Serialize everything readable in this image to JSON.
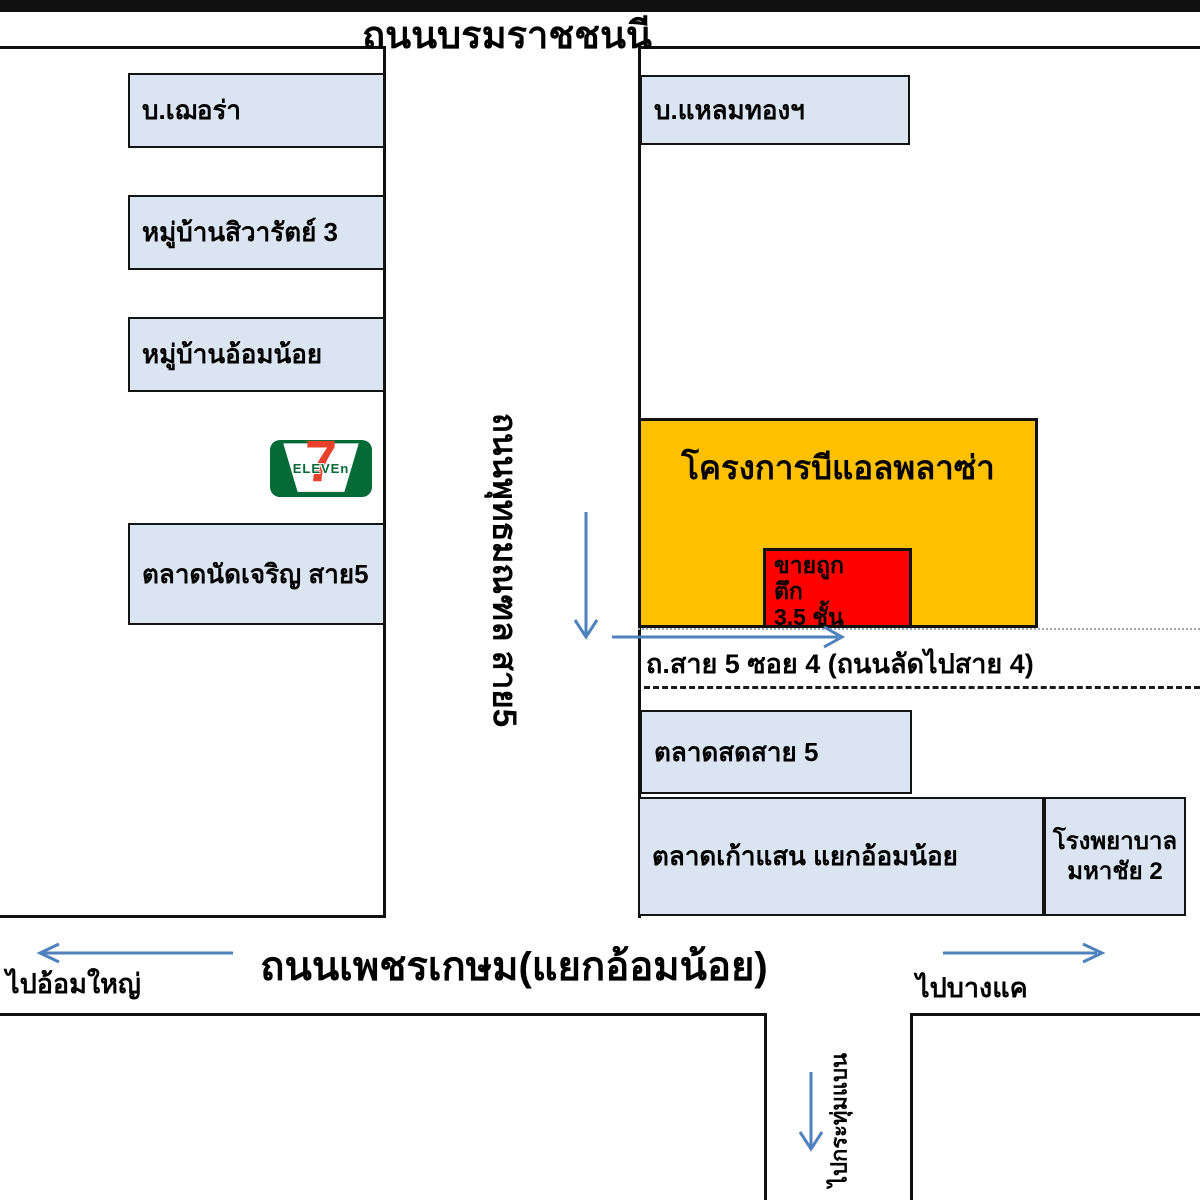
{
  "roads": {
    "top": "ถนนบรมราชชนนี",
    "sai5": "ถนนพุทธมณฑล สาย5",
    "soi": "ถ.สาย 5 ซอย 4 (ถนนลัดไปสาย 4)",
    "phetkasem": "ถนนเพชรเกษม(แยกอ้อมน้อย)",
    "to_om_yai": "ไปอ้อมใหญ่",
    "to_bang_khae": "ไปบางแค",
    "to_krathum_baen": "ไปกระทุ่มแบน"
  },
  "left_area": {
    "chera": "บ.เฌอร่า",
    "siwarat_village": "หมู่บ้านสิวารัตย์ 3",
    "om_noi_village": "หมู่บ้านอ้อมน้อย",
    "charoen_market": "ตลาดนัดเจริญ สาย5"
  },
  "seven_eleven": {
    "seven": "7",
    "eleven": "ELEVEn"
  },
  "right_area": {
    "laem_thong": "บ.แหลมทองฯ",
    "plaza_title": "โครงการบีแอลพลาซ่า",
    "sale_sign": [
      "ขายถูก",
      "ตึก",
      "3.5 ชั้น"
    ],
    "fresh_market": "ตลาดสดสาย 5",
    "kao_saen_market": "ตลาดเก้าแสน แยกอ้อมน้อย",
    "hospital": [
      "โรงพยาบาล",
      "มหาชัย 2"
    ]
  },
  "colors": {
    "landmark_fill": "#dbe5f1",
    "plaza_fill": "#ffc000",
    "sale_fill": "#fe0000",
    "arrow": "#4f81bd",
    "seven_green": "#046a38",
    "seven_red": "#e8402a"
  }
}
